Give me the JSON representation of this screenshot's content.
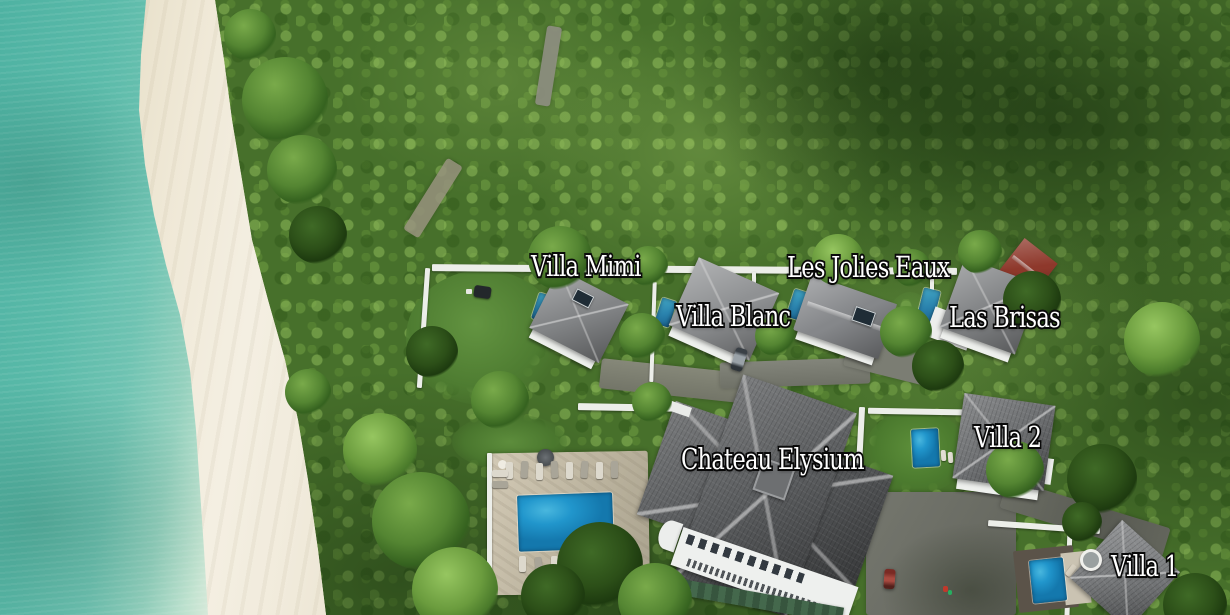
{
  "scene": {
    "type": "aerial-photograph",
    "description": "Aerial drone view of a tropical beachfront estate: turquoise sea and white sand beach on the left, dense forest canopy, a row of white villas with gray hip roofs, private plunge pools, a large shared swimming pool with sun loungers, driveways and boundary walls",
    "colors": {
      "ocean": "#5abaa9",
      "shallow_water": "#bfe2cf",
      "sand": "#efe8d6",
      "forest": "#47702b",
      "forest_shadow": "#1d3a0f",
      "roof_gray": "#828486",
      "roof_dark": "#595b5d",
      "roof_red": "#8e382b",
      "pool_blue": "#2196cc",
      "deck_stone": "#c9c0ac",
      "wall_white": "#eceee9",
      "label_fill": "#ffffff",
      "label_outline": "#0b0b0b"
    }
  },
  "labels": [
    {
      "id": "villa-mimi",
      "text": "Villa Mimi"
    },
    {
      "id": "les-jolies-eaux",
      "text": "Les Jolies Eaux"
    },
    {
      "id": "villa-blanc",
      "text": "Villa Blanc"
    },
    {
      "id": "las-brisas",
      "text": "Las Brisas"
    },
    {
      "id": "chateau-elysium",
      "text": "Chateau Elysium"
    },
    {
      "id": "villa-2",
      "text": "Villa 2"
    },
    {
      "id": "villa-1",
      "text": "Villa 1"
    }
  ]
}
